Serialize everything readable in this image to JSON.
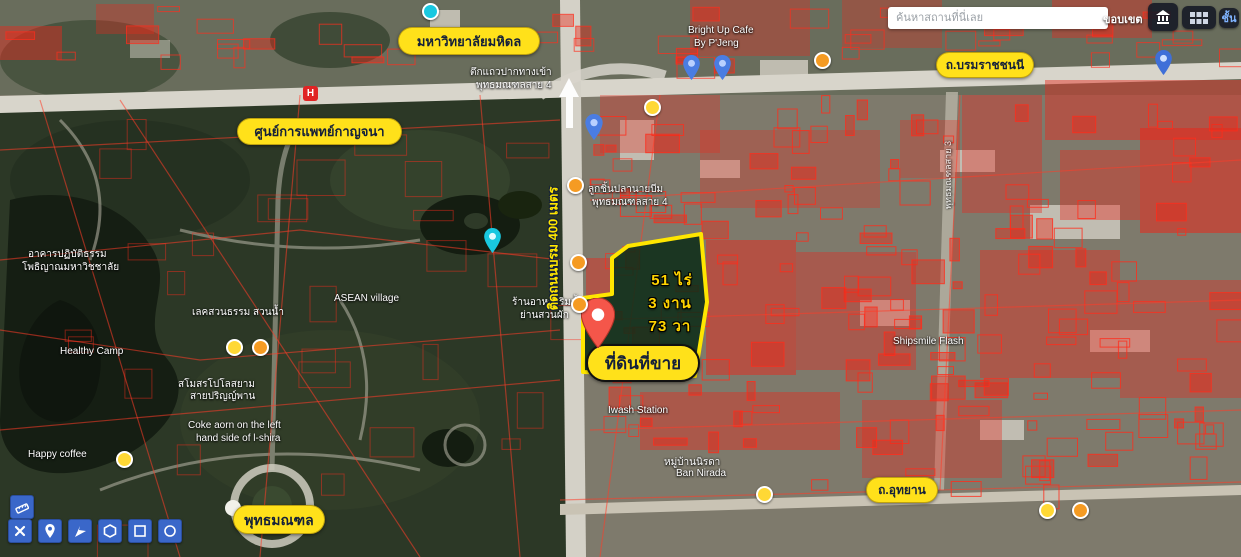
{
  "search": {
    "placeholder": "ค้นหาสถานที่นี่เลย"
  },
  "topbar": {
    "boundary_label": "ขอบเขต",
    "layers_label": "ชั้น"
  },
  "road_labels": {
    "borom": "ถ.บรมราชชนนี",
    "utthayan": "ถ.อุทยาน",
    "sai3": "พุทธมณฑลสาย 3"
  },
  "place_labels": {
    "mahidol": "มหาวิทยาลัยมหิดล",
    "kanchana": "ศูนย์การแพทย์กาญจนา",
    "phutthamonthon": "พุทธมณฑล"
  },
  "property": {
    "rai": "51 ไร่",
    "ngan": "3 งาน",
    "wa": "73 วา",
    "sale_label": "ที่ดินที่ขาย",
    "frontage": "ติดถนนบรม 400 เมตร"
  },
  "poi": {
    "dhamma_hall_1": "อาคารปฏิบัติธรรม",
    "dhamma_hall_2": "โพธิญาณมหาวิชชาลัย",
    "lake_garden": "เลคสวนธรรม สวนน้ำ",
    "polo_1": "สโมสรโปโลสยาม",
    "polo_2": "สายปริญญ์พาน",
    "healthy_camp": "Healthy Camp",
    "happy_coffee": "Happy coffee",
    "coke_1": "Coke aorn on the left",
    "coke_2": "hand side of l-shira",
    "asean_village": "ASEAN village",
    "bright_up_1": "Bright Up Cafe",
    "bright_up_2": "By P'Jeng",
    "shophouse_1": "ตึกแถวปากทางเข้า",
    "shophouse_2": "พุทธมณฑลสาย 4",
    "fishball_1": "ลูกชิ้นปลานายบีม",
    "fishball_2": "พุทธมณฑลสาย 4",
    "riverside_1": "ร้านอาหารริมน้ำ",
    "riverside_2": "ย่านสวนผัก",
    "wash_station": "Iwash Station",
    "shipsmile": "Shipsmile Flash",
    "nirada_1": "หมู่บ้านนิรดา",
    "nirada_2": "Ban Nirada"
  },
  "markers": {
    "hospital_letter": "H"
  }
}
